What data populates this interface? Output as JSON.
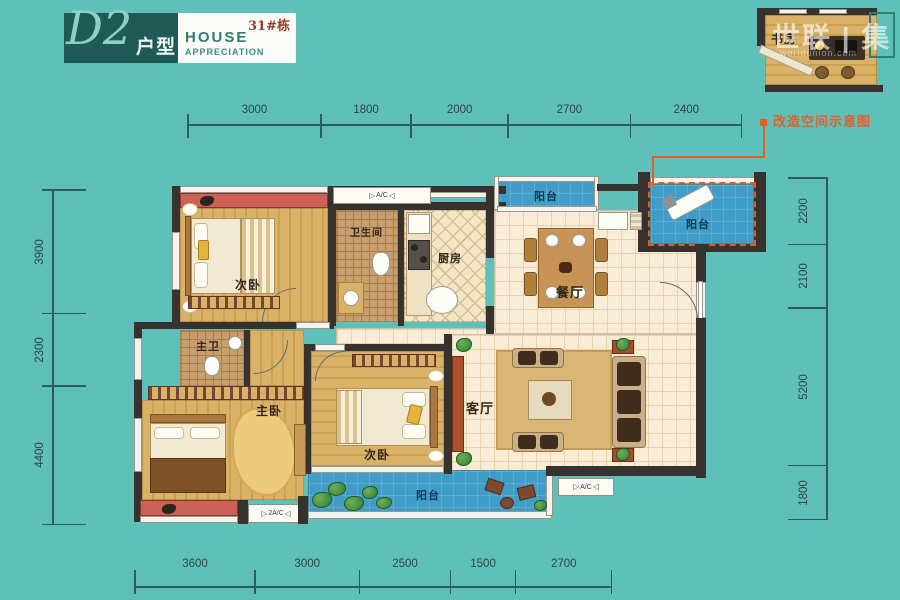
{
  "logo": {
    "model": "D2",
    "suffix": "户型",
    "building": "31#栋",
    "line1": "HOUSE",
    "line2": "APPRECIATION"
  },
  "watermark": {
    "brand": "世联 | 集",
    "url": "worldunion.com"
  },
  "inset": {
    "room": "书房",
    "caption": "改造空间示意图"
  },
  "rooms": {
    "bedroom_top": "次卧",
    "bathroom": "卫生间",
    "kitchen": "厨房",
    "balcony_top": "阳台",
    "dining": "餐厅",
    "balcony_right": "阳台",
    "living": "客厅",
    "master_bath": "主卫",
    "master_bedroom": "主卧",
    "bedroom_bottom": "次卧",
    "balcony_bottom": "阳台"
  },
  "ac": {
    "top": "A/C",
    "living": "A/C",
    "master": "2A/C"
  },
  "icons": {
    "ac_left": "▷",
    "ac_right": "◁"
  },
  "dimensions": {
    "top": [
      "3000",
      "1800",
      "2000",
      "2700",
      "2400"
    ],
    "bottom": [
      "3600",
      "3000",
      "2500",
      "1500",
      "2700"
    ],
    "left": [
      "3900",
      "2300",
      "4400"
    ],
    "right": [
      "2200",
      "2100",
      "5200",
      "1800"
    ]
  },
  "colors": {
    "background": "#5ec0b9",
    "accent_orange": "#e0622a",
    "balcony_blue": "#3f9dc8",
    "bay_red": "#cd6156",
    "wall": "#38322e"
  }
}
